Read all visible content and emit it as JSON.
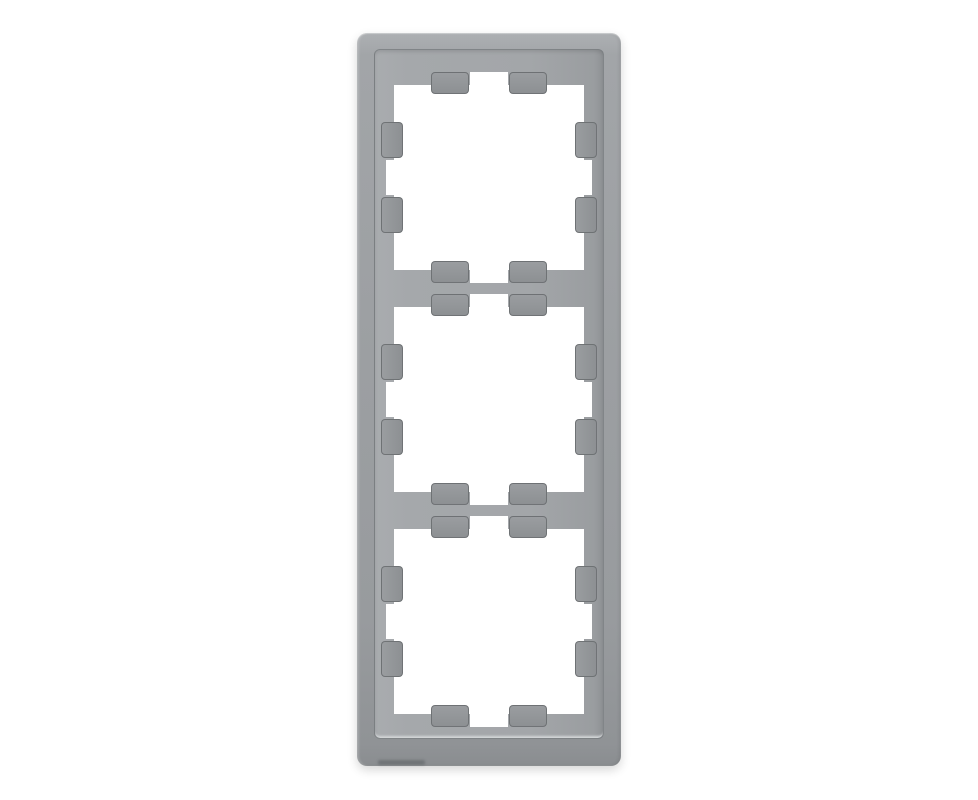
{
  "image": {
    "type": "product-photo",
    "subject": "triple-gang switch frame, grey stainless finish, three square castellated openings on white background",
    "background_color": "#ffffff",
    "openings_count": 3,
    "colors": {
      "frame_outer": "#9c9fa2",
      "frame_outer_highlight": "#adb0b3",
      "frame_outer_shadow": "#8a8d90",
      "inner_plate": "#a3a6a9",
      "inner_plate_dark_side": "#8f9295",
      "bevel_edge_line": "#74787b",
      "bottom_highlight_line": "#d4d7d9",
      "tab_block": "#8f9295",
      "tab_outline": "#686c6f",
      "opening_fill": "#ffffff"
    }
  }
}
